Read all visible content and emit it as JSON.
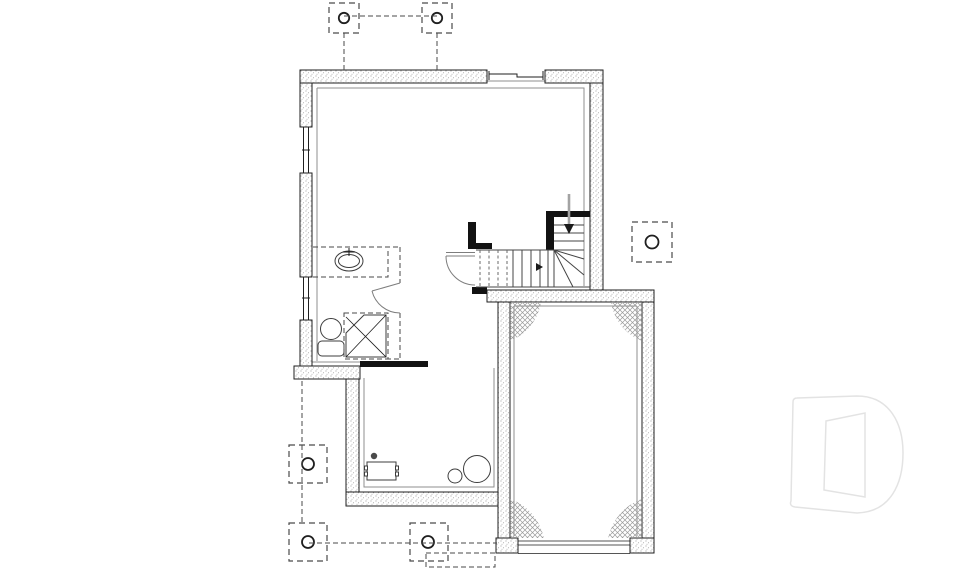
{
  "document": {
    "kind": "architectural floor plan, foundation / basement level, no text labels",
    "visible_text": []
  },
  "colors": {
    "background": "#ffffff",
    "line": "#1f1f1f",
    "inner_line": "#8f8f8f",
    "dashed": "#4a4a4a",
    "stipple_dot": "#a9a9a9",
    "hatch": "#9b9b9b",
    "partition": "#121212",
    "door_line": "#7d7d7d",
    "arrow_shaft": "#a3a3a3",
    "arrow_head": "#1a1a1a",
    "logo": "#e3e3e3"
  },
  "symbols": {
    "stippled_wall": "poured concrete foundation wall",
    "pier_footing": "dashed footing pad with round post",
    "corner_hatch": "garage slab corner hatch",
    "black_wall": "framed partition wall",
    "dashed_fixtures": "optional bathroom rough-in",
    "stair_arrow": "stair direction arrow",
    "logo_letter": "D"
  }
}
